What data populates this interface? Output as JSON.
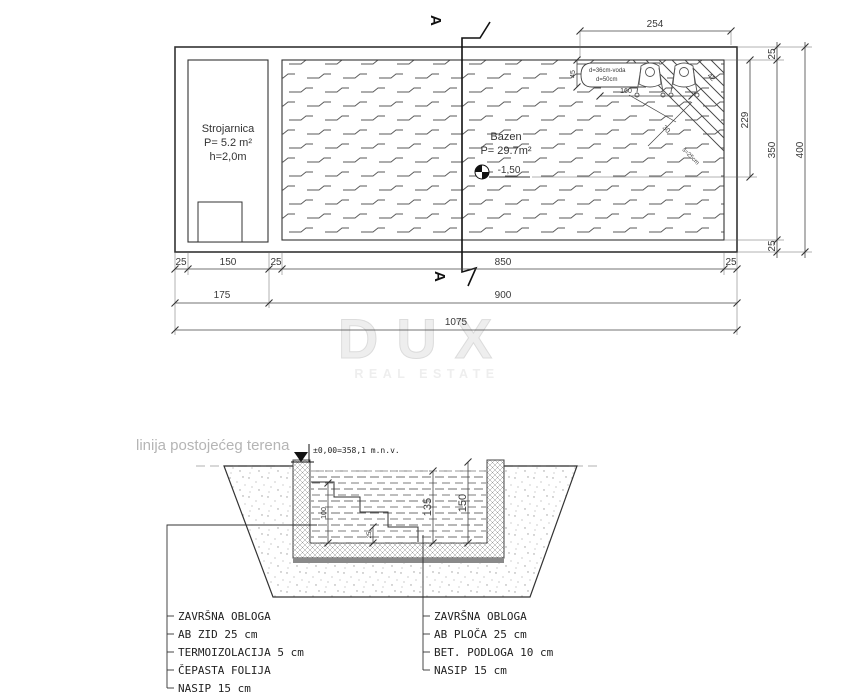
{
  "colors": {
    "line": "#333333",
    "dim_text": "#3a3a3a",
    "terrain_label": "#b5b5b5",
    "watermark": "#e6e6e6",
    "podloga": "#8a8a8a"
  },
  "watermark": {
    "title": "DUX",
    "subtitle": "REAL ESTATE"
  },
  "plan": {
    "strojarnica": {
      "name": "Strojarnica",
      "area": "P= 5.2 m²",
      "height": "h=2,0m"
    },
    "bazen": {
      "name": "Bazen",
      "area": "P= 29.7m²",
      "level": "-1,50"
    },
    "section_letter": "A",
    "bench": {
      "note_line1": "d=36cm-voda",
      "note_line2": "d=50cm"
    },
    "dims": {
      "bench_width": "254",
      "bench_depth": "45",
      "bench_length": "160",
      "stair_edge": "42",
      "stair_tread": "30",
      "stair_note": "š=25cm",
      "pool_inner_offset": "229",
      "wall_top": "25",
      "inner_height": "350",
      "wall_bottom": "25",
      "total_height": "400",
      "wall_left": "25",
      "strojarnica_width": "150",
      "wall_mid": "25",
      "pool_width": "850",
      "wall_right": "25",
      "left_block": "175",
      "pool_block": "900",
      "total_width": "1075"
    }
  },
  "section": {
    "terrain_label": "linija postojećeg terena",
    "datum": "±0,00=358,1 m.n.v.",
    "dims": {
      "steps_height": "100",
      "water_depth": "135",
      "pool_depth": "150",
      "step_rise": "25"
    },
    "legend_left": [
      "ZAVRŠNA OBLOGA",
      "AB ZID 25 cm",
      "TERMOIZOLACIJA 5 cm",
      "ČEPASTA FOLIJA",
      "NASIP 15 cm"
    ],
    "legend_right": [
      "ZAVRŠNA OBLOGA",
      "AB PLOČA 25 cm",
      "BET. PODLOGA 10 cm",
      "NASIP 15 cm"
    ]
  }
}
